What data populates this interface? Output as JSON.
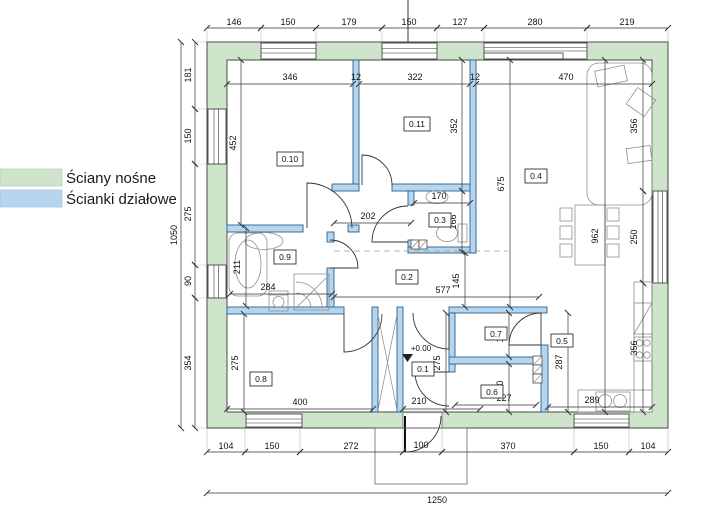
{
  "legend": {
    "items": [
      {
        "name": "load-bearing-walls",
        "label": "Ściany nośne",
        "color": "#cfe5cb"
      },
      {
        "name": "partition-walls",
        "label": "Ścianki działowe",
        "color": "#b5d6ee"
      }
    ]
  },
  "colors": {
    "load_bearing": "#cfe5cb",
    "partition": "#b5d6ee"
  },
  "plan": {
    "rooms": {
      "r1": "0.1",
      "r2": "0.2",
      "r3": "0.3",
      "r4": "0.4",
      "r5": "0.5",
      "r6": "0.6",
      "r7": "0.7",
      "r8": "0.8",
      "r9": "0.9",
      "r10": "0.10",
      "r11": "0.11"
    },
    "level": "+0.00",
    "dims": {
      "top": [
        "146",
        "150",
        "179",
        "150",
        "127",
        "280",
        "219"
      ],
      "left": [
        "181",
        "150",
        "275",
        "90",
        "354"
      ],
      "left_total": "1050",
      "bottom": [
        "104",
        "150",
        "272",
        "100",
        "370",
        "150",
        "104"
      ],
      "bottom_total": "1250",
      "interior": {
        "room10_width": "346",
        "wall_a": "12",
        "room11_width": "322",
        "wall_b": "12",
        "room4_width": "470",
        "room10_height": "452",
        "room11_height": "352",
        "room4_height": "675",
        "great_height": "962",
        "sofa_len": "356",
        "window_len": "250",
        "counter_len": "356",
        "bath_height": "211",
        "wc_height": "166",
        "corridor_width": "145",
        "room8_height": "275",
        "room1_height": "275",
        "kitchen_height": "287",
        "room7_height": "140",
        "room6_height": "140",
        "hall_width": "202",
        "wc_width": "170",
        "bath_width": "284",
        "corridor_length": "577",
        "room8_width": "400",
        "room1_width": "210",
        "room6_width": "227",
        "kitchen_width": "289"
      }
    }
  }
}
